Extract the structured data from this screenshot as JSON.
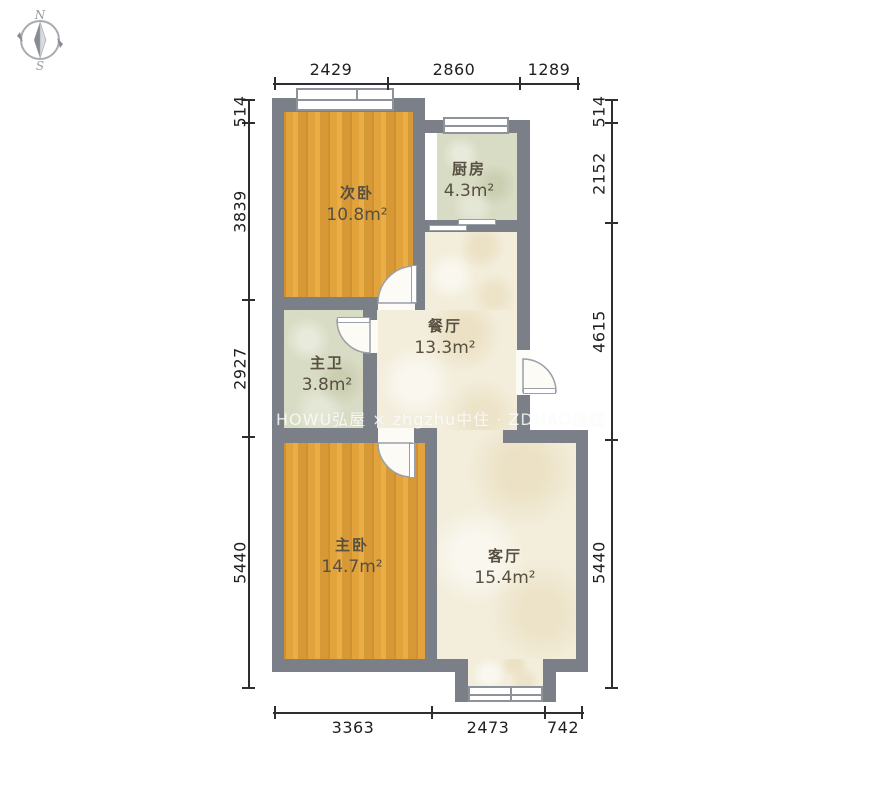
{
  "compass": {
    "north": "N",
    "south": "S"
  },
  "watermark": "HOWU弘屋 × zhgzhu中住 · ZDHAO佳住",
  "rooms": {
    "secondary_bedroom": {
      "name": "次卧",
      "area": "10.8m²"
    },
    "kitchen": {
      "name": "厨房",
      "area": "4.3m²"
    },
    "master_bathroom": {
      "name": "主卫",
      "area": "3.8m²"
    },
    "dining_room": {
      "name": "餐厅",
      "area": "13.3m²"
    },
    "master_bedroom": {
      "name": "主卧",
      "area": "14.7m²"
    },
    "living_room": {
      "name": "客厅",
      "area": "15.4m²"
    }
  },
  "dimensions": {
    "top": [
      "2429",
      "2860",
      "1289"
    ],
    "bottom": [
      "3363",
      "2473",
      "742"
    ],
    "left": [
      "514",
      "3839",
      "2927",
      "5440"
    ],
    "right": [
      "514",
      "2152",
      "4615",
      "5440"
    ]
  },
  "colors": {
    "wall": "#7a7f88",
    "wood_floor": "#e2a23c",
    "tile_floor": "#d9dcc4",
    "marble_floor": "#f3eedc",
    "dimension_text": "#1f1f1f",
    "room_text": "#564f42"
  }
}
